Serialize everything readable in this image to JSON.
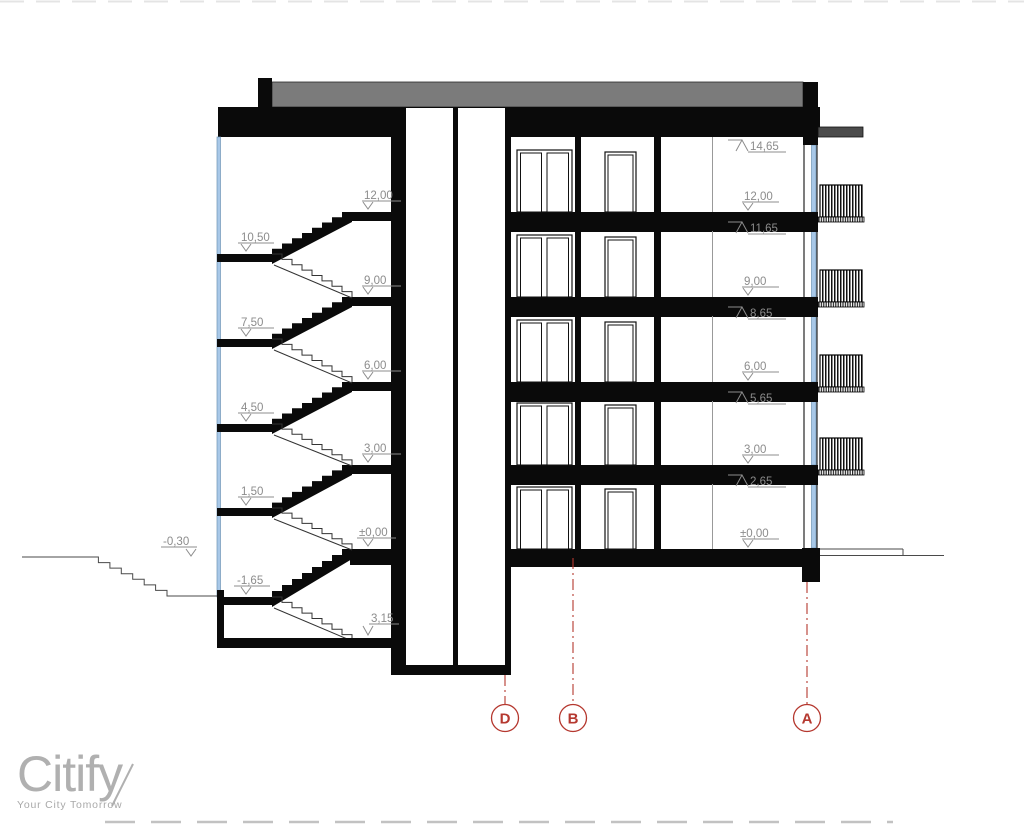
{
  "logo": {
    "name": "Citify",
    "tagline": "Your City Tomorrow"
  },
  "grid_markers": [
    "D",
    "B",
    "A"
  ],
  "levels": {
    "left_floors": [
      "12,00",
      "9,00",
      "6,00",
      "3,00",
      "±0,00"
    ],
    "left_basement": "3,15",
    "left_landings": [
      "10,50",
      "7,50",
      "4,50",
      "1,50",
      "-1,65"
    ],
    "ground": "-0,30",
    "right_floors": [
      "12,00",
      "9,00",
      "6,00",
      "3,00",
      "±0,00"
    ],
    "right_ceilings": [
      "14,65",
      "11,65",
      "8,65",
      "5,65",
      "2,65"
    ]
  },
  "colors": {
    "line_black": "#0a0a0a",
    "roof_gray": "#7b7b7b",
    "overhang_gray": "#4b4b4b",
    "glazing_blue": "#a8c8e8",
    "glazing_edge": "#6f94b5",
    "grid_red": "#b5382f",
    "annotation_gray": "#8c8c8c",
    "ground_line": "#4a4a4a"
  }
}
